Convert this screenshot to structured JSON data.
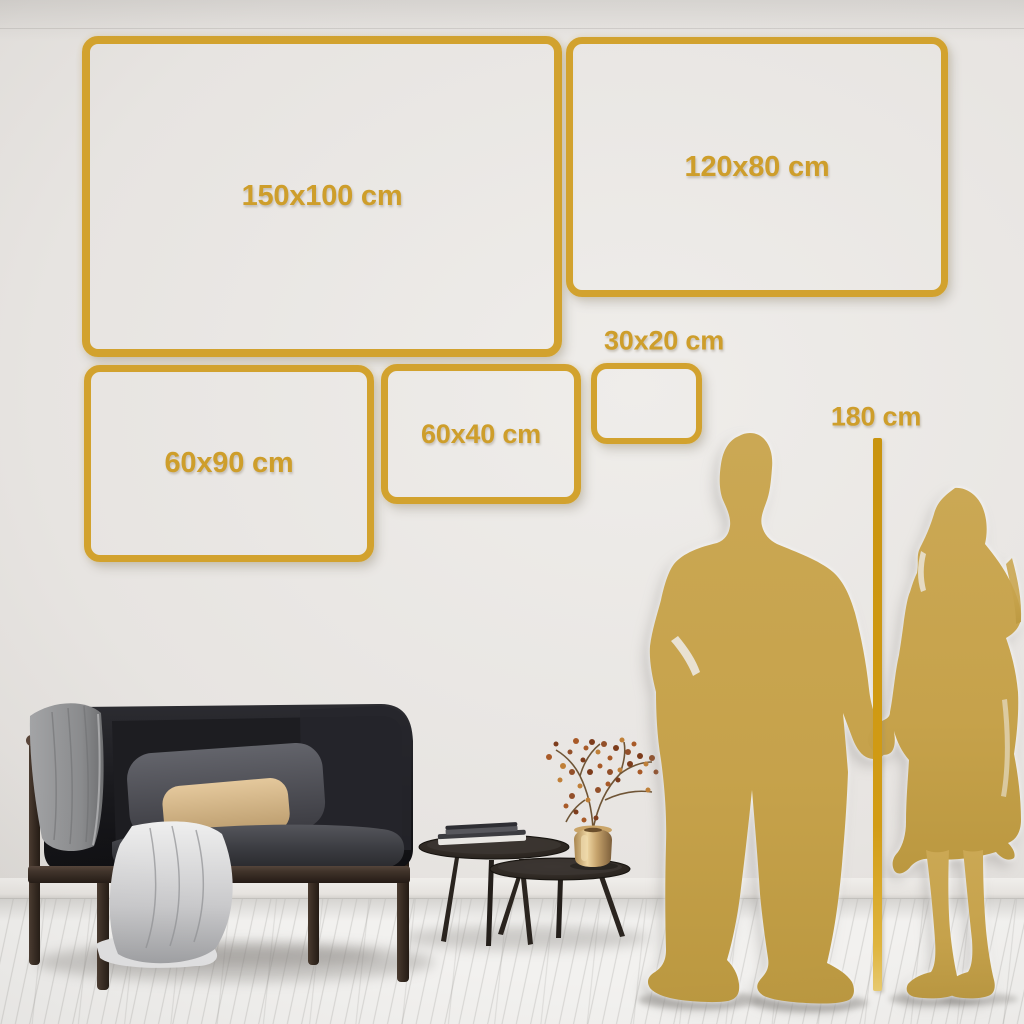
{
  "size_frames": [
    {
      "label": "150x100 cm"
    },
    {
      "label": "120x80 cm"
    },
    {
      "label": "60x90 cm"
    },
    {
      "label": "60x40 cm"
    },
    {
      "label": "30x20 cm"
    }
  ],
  "ruler": {
    "label": "180 cm"
  },
  "colors": {
    "frame_gold": "#D2A22E",
    "label_gold": "#CE9E2B",
    "ruler_gold": "#D29C15",
    "silhouette_gold": "#C6A24B",
    "wall": "#E7E4E1",
    "floor": "#F2F1EF"
  },
  "scene": {
    "objects": [
      "black-sofa-with-gray-throw",
      "gray-cushion",
      "tan-cushion",
      "nesting-coffee-tables",
      "stacked-books",
      "brass-vase-with-dried-branch",
      "couple-silhouette-holding-hands",
      "white-plank-floor"
    ]
  }
}
